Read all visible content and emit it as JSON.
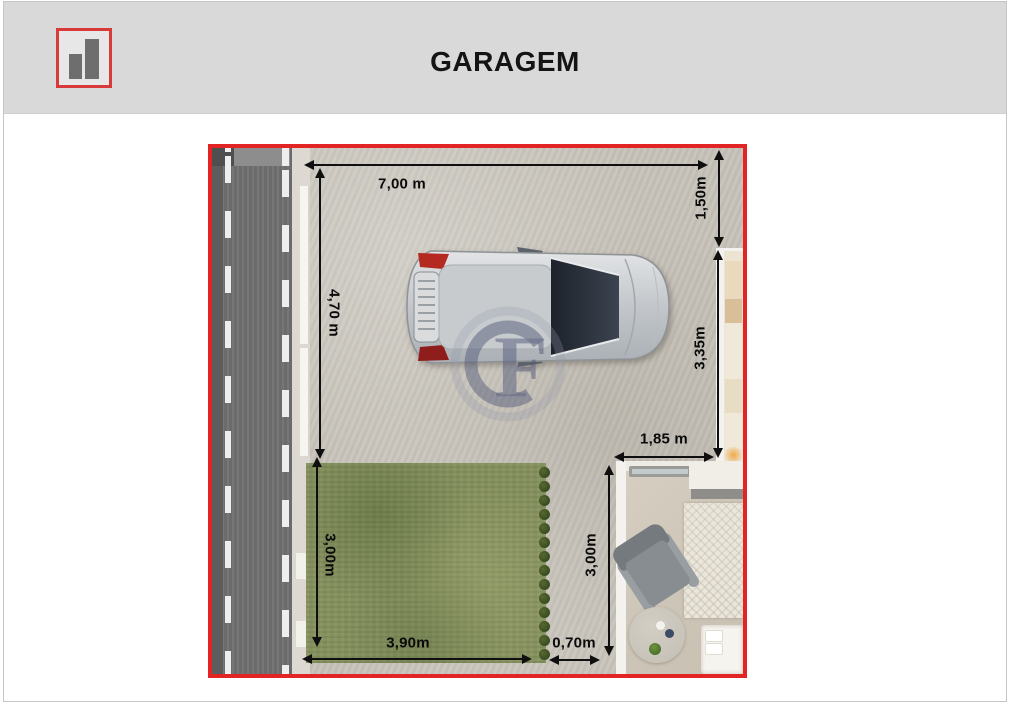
{
  "header": {
    "title": "GARAGEM",
    "logo_icon": "bar-chart-icon"
  },
  "plan": {
    "dimensions": [
      {
        "id": "garage-width-top",
        "label": "7,00 m"
      },
      {
        "id": "right-upper-depth",
        "label": "1,50m"
      },
      {
        "id": "garage-depth-left",
        "label": "4,70 m"
      },
      {
        "id": "right-mid-depth",
        "label": "3,35m"
      },
      {
        "id": "patio-width",
        "label": "1,85 m"
      },
      {
        "id": "lawn-depth",
        "label": "3,00m"
      },
      {
        "id": "lawn-width",
        "label": "3,90m"
      },
      {
        "id": "path-width",
        "label": "0,70m"
      },
      {
        "id": "room-depth",
        "label": "3,00m"
      }
    ],
    "watermark": {
      "letter": "F"
    },
    "colors": {
      "plan_border": "#e32424",
      "concrete": "#c6c2b9",
      "grass": "#85905f",
      "road": "#717171",
      "room_floor": "#cfc7b9",
      "logo_red": "#d83a3a"
    }
  }
}
